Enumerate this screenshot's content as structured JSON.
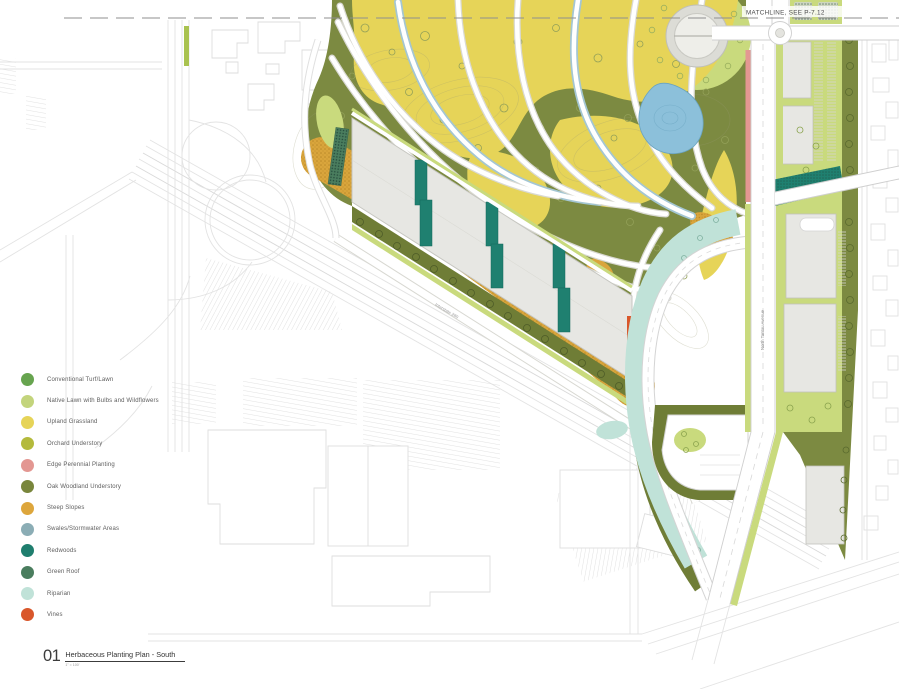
{
  "drawing": {
    "matchline_label": "MATCHLINE, SEE P-7.12",
    "interstate_label": "Interstate 280",
    "street_label": "North Tantau Avenue"
  },
  "legend": {
    "items": [
      {
        "label": "Conventional Turf/Lawn",
        "color": "#67a44f"
      },
      {
        "label": "Native Lawn with Bulbs and Wildflowers",
        "color": "#c3d47c"
      },
      {
        "label": "Upland Grassland",
        "color": "#e6d458"
      },
      {
        "label": "Orchard Understory",
        "color": "#b4ba3c"
      },
      {
        "label": "Edge Perennial Planting",
        "color": "#e39792"
      },
      {
        "label": "Oak Woodland Understory",
        "color": "#79863c"
      },
      {
        "label": "Steep Slopes",
        "color": "#dda63c"
      },
      {
        "label": "Swales/Stormwater Areas",
        "color": "#8badb5"
      },
      {
        "label": "Redwoods",
        "color": "#1f7e6e"
      },
      {
        "label": "Green Roof",
        "color": "#4a7d5e",
        "pattern": "dots"
      },
      {
        "label": "Riparian",
        "color": "#c0e2d8"
      },
      {
        "label": "Vines",
        "color": "#d9572b"
      }
    ]
  },
  "title_block": {
    "number": "01",
    "title": "Herbaceous Planting Plan - South",
    "scale": "1\" = 100'"
  }
}
